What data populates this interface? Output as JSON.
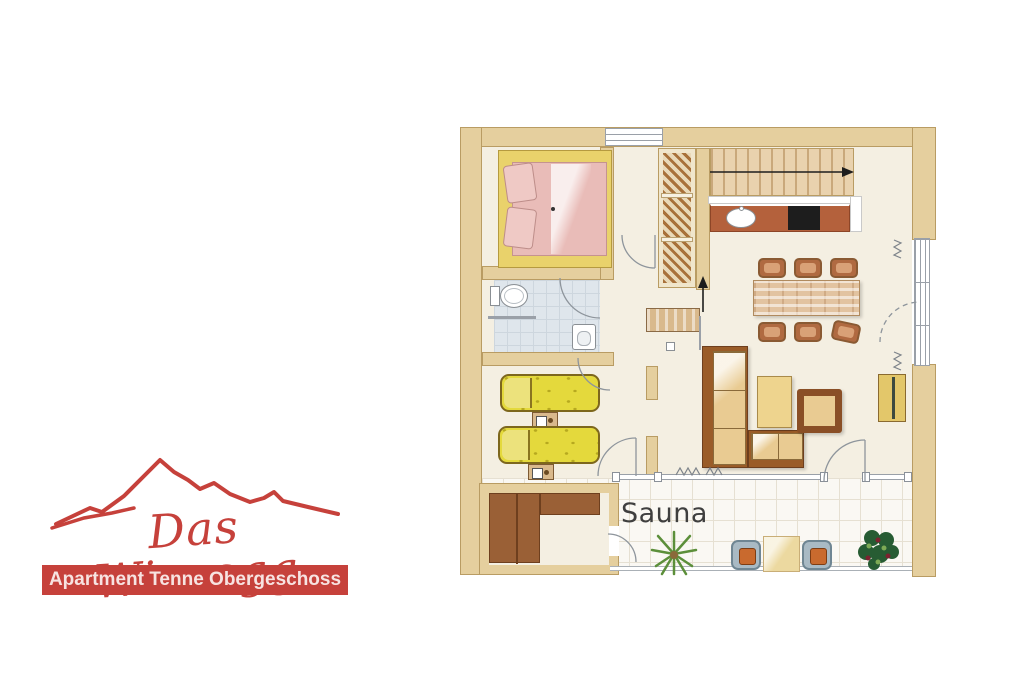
{
  "logo": {
    "brand": "Das Wiesegg",
    "banner": "Apartment Tenne Obergeschoss"
  },
  "plan": {
    "sauna_label": "Sauna"
  },
  "theme": {
    "brand-red": "#c6413b",
    "banner-text": "#f7e3e1",
    "wall": "#e5cf9e",
    "wall-edge": "#b99c63",
    "floor": "#f4efe2",
    "terrace-floor": "#faf8f3",
    "terrace-grid": "#e6e0d2",
    "bath-floor": "#dfe6ec",
    "bed-frame-yellow": "#e9d26b",
    "bed-pink": "#e9bcb8",
    "single-bed-yellow": "#e4d93c",
    "kitchen-counter": "#b4613c",
    "stair-tread": "#e9d2ae",
    "wood": "#e2c3a0",
    "chair-brown": "#b06a41",
    "sofa-frame": "#9a5c28",
    "cushion": "#e9cb92",
    "table-yellow": "#eed48e",
    "sauna-bench": "#9a6036",
    "hatch-brown": "#a8713a",
    "plant-green": "#5c8f3a",
    "plant-dark": "#275c33",
    "label-ink": "#3f3f3f",
    "line-gray": "#8e959c"
  }
}
